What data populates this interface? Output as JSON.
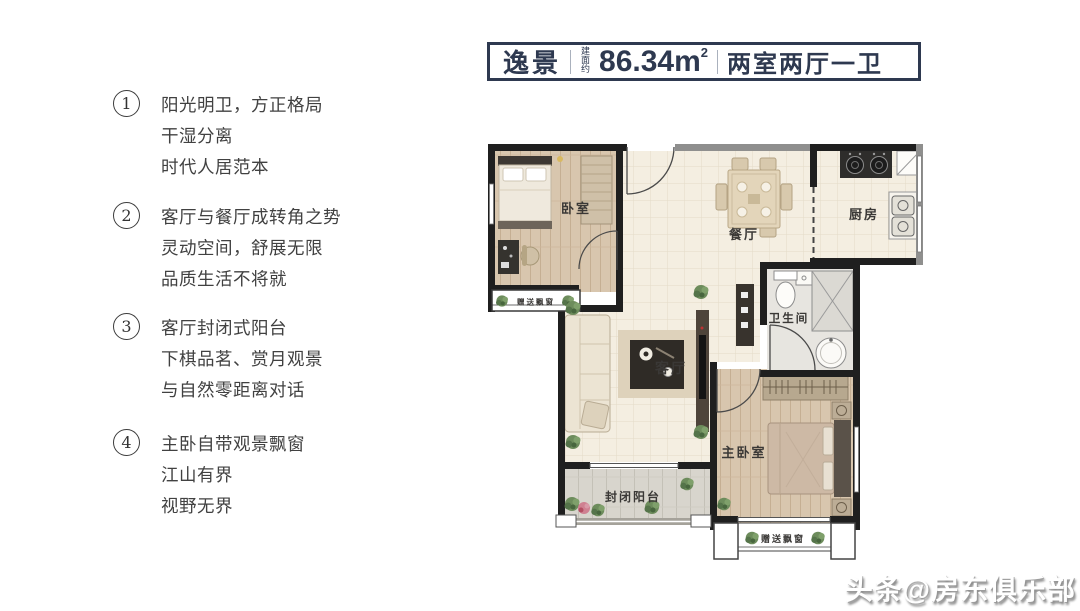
{
  "title": {
    "name": "逸景",
    "area_prefix": "建面约",
    "area_value": "86.34m",
    "area_sup": "2",
    "layout": "两室两厅一卫"
  },
  "features": [
    {
      "num": "1",
      "lines": [
        "阳光明卫，方正格局",
        "干湿分离",
        "时代人居范本"
      ]
    },
    {
      "num": "2",
      "lines": [
        "客厅与餐厅成转角之势",
        "灵动空间，舒展无限",
        "品质生活不将就"
      ]
    },
    {
      "num": "3",
      "lines": [
        "客厅封闭式阳台",
        "下棋品茗、赏月观景",
        "与自然零距离对话"
      ]
    },
    {
      "num": "4",
      "lines": [
        "主卧自带观景飘窗",
        "江山有界",
        "视野无界"
      ]
    }
  ],
  "floorplan": {
    "labels": {
      "bedroom": "卧室",
      "dining": "餐厅",
      "kitchen": "厨房",
      "bathroom": "卫生间",
      "living": "客厅",
      "master_bedroom": "主卧室",
      "balcony": "封闭阳台",
      "bay_window_small": "赠送飘窗",
      "bay_window_master": "赠送飘窗"
    }
  },
  "watermark": "头条@房东俱乐部",
  "colors": {
    "accent": "#2e3950",
    "wall": "#1f1f1f",
    "wall_gray": "#8f8f8e",
    "floor_tile": "#f4eee1",
    "floor_wood": "#d8c6ae",
    "balcony_floor": "#d8d5cd"
  }
}
